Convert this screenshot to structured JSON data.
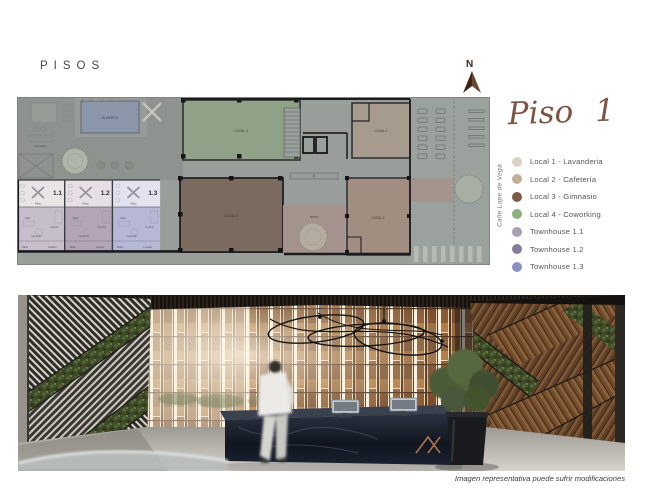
{
  "page": {
    "title": "PISOS"
  },
  "plan": {
    "north_label": "N",
    "street_label": "Calle Lope de Vega",
    "labels": {
      "alberca": "ALBERCA",
      "lounge": "LOUNGE",
      "patio_large": "PATIO",
      "patio_small": "Patio",
      "local_1": "LOCAL 1",
      "local_2": "LOCAL 2",
      "local_3": "LOCAL 3",
      "local_4": "LOCAL 4",
      "th_1": "1.1",
      "th_2": "1.2",
      "th_3": "1.3",
      "sala": "Sala",
      "cocina": "Cocina",
      "comedor": "Comedor",
      "bano": "Baño",
      "lavado": "Lavado"
    }
  },
  "legend": {
    "title": "Piso 1",
    "items": [
      {
        "label": "Local 1 - Lavanderia",
        "color": "#dcd2c3"
      },
      {
        "label": "Local 2 - Cafetería",
        "color": "#c1ad99"
      },
      {
        "label": "Local 3 - Gimnasio",
        "color": "#7a5a43"
      },
      {
        "label": "Local 4 - Coworking",
        "color": "#8daf82"
      },
      {
        "label": "Townhouse 1.1",
        "color": "#a89fb3"
      },
      {
        "label": "Townhouse 1.2",
        "color": "#857a99"
      },
      {
        "label": "Townhouse 1.3",
        "color": "#8890bf"
      }
    ]
  },
  "photo": {
    "caption": "Imagen representativa puede sufrir modificaciones"
  }
}
